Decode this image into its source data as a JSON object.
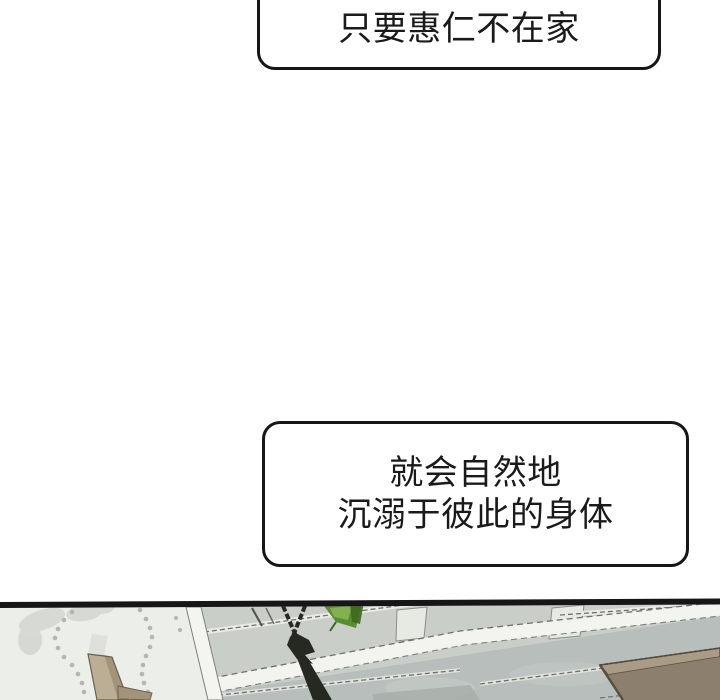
{
  "page": {
    "background": "#ffffff",
    "type": "webtoon-strip"
  },
  "bubbles": {
    "top": {
      "text": "只要惠仁不在家"
    },
    "middle": {
      "line1": "就会自然地",
      "line2": "沉溺于彼此的身体"
    }
  },
  "panel": {
    "colors": {
      "outline": "#161616",
      "paneling": "#c9cec9",
      "paneling_lower": "#b8bebb",
      "wall": "#ebeee9",
      "corner_strip": "#f4f5f0",
      "band": "#f3f4f0",
      "post_white": "#e7eae3",
      "stitch": "#6e726c",
      "chain": "#262922",
      "leaf": "#5a8d31",
      "leaf_light": "#83b150",
      "leaf_dark": "#3c681d",
      "wood_light": "#bcae94",
      "wood_dark": "#a29379",
      "box_top": "#a99b85",
      "box_front": "#8c7f6e",
      "dots": "#b3b7af"
    }
  }
}
